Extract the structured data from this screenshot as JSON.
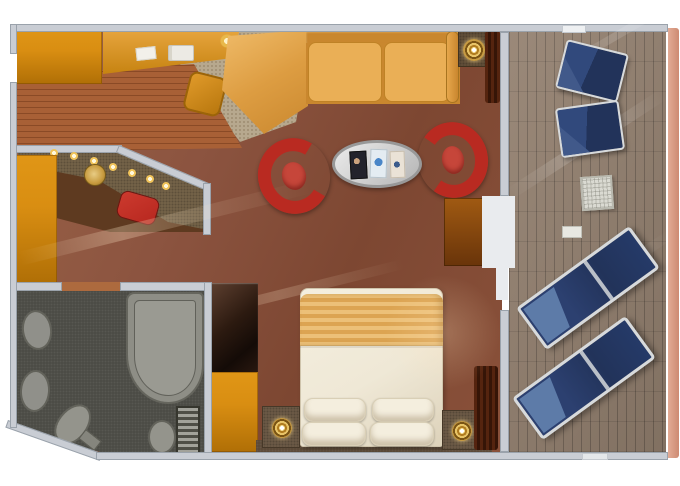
{
  "palette": {
    "bg": "#ffffff",
    "wall": "#c9cdd4",
    "wall-edge": "#9aa2ab",
    "door-white": "#e9ebee",
    "carpet-a": "#9a6347",
    "carpet-b": "#7d4732",
    "carpet-desk": "#b7a88e",
    "wood-a": "#a86036",
    "wood-b": "#8a4a26",
    "orange": "#d98e12",
    "orange-dark": "#b06f06",
    "sofa": "#e6a74c",
    "sofa-dark": "#c9872e",
    "sofa-cushion": "#eaaf56",
    "chair-red": "#b92a21",
    "chair-seat": "#c6463a",
    "stool-red": "#b7271f",
    "table-silver": "#d6d6d6",
    "counter": "#77654a",
    "nook-floor": "#5e3a20",
    "bath-floor": "#4a4a44",
    "bath-fixture": "#90908a",
    "bath-edge": "#62625a",
    "cabinet-dark": "#2c1a10",
    "duvet": "#efe8d6",
    "blanket-a": "#ecc078",
    "blanket-b": "#dca452",
    "pillow": "#f4eede",
    "trim-dark": "#5a4836",
    "nightstand": "#6e5c48",
    "gold": "#e0b44e",
    "deck-a": "#93806f",
    "deck-b": "#7a685b",
    "hull-a": "#e3ac96",
    "hull-b": "#cd8a72",
    "lounger-navy": "#22335a",
    "lounger-light": "#5d7ba8",
    "frame-silver": "#d7dadc",
    "curtain-a": "#55240f",
    "curtain-b": "#361507"
  },
  "scene": {
    "cabin": {
      "entry": [
        "entry-door-opening",
        "wood-floor",
        "entry-closet",
        "wardrobe-column"
      ],
      "vanity-nook": [
        "angled-wall",
        "spot-lights",
        "vanity-counter",
        "vanity-sink",
        "vanity-stool"
      ],
      "living-area": [
        "writing-desk",
        "desk-phone",
        "desk-paper",
        "desk-lamp-glow",
        "desk-chair",
        "desk-area-rug",
        "corner-sofa",
        "sofa-armrest",
        "armchair-left",
        "armchair-right",
        "oval-coffee-table",
        "magazine-dark",
        "magazine-blue",
        "magazine-light",
        "floor-lamp",
        "window-curtain",
        "tv-cabinet"
      ],
      "bedroom": [
        "closet-column-dark",
        "closet-column-orange",
        "double-bed",
        "bed-blanket",
        "bed-pillows",
        "nightstand-left",
        "nightstand-right",
        "bedside-lamp-left",
        "bedside-lamp-right",
        "headboard-ledge",
        "bedroom-curtain"
      ],
      "bathroom": [
        "bathroom-door-opening",
        "washbasin-upper",
        "washbasin-lower",
        "bathtub",
        "toilet",
        "bidet",
        "towel-radiator"
      ]
    },
    "balcony": [
      "balcony-door",
      "deck-planks",
      "deck-chair-upper",
      "deck-chair-lower",
      "side-table",
      "deck-pad",
      "sun-lounger-upper",
      "sun-lounger-lower",
      "ship-hull-edge"
    ]
  }
}
